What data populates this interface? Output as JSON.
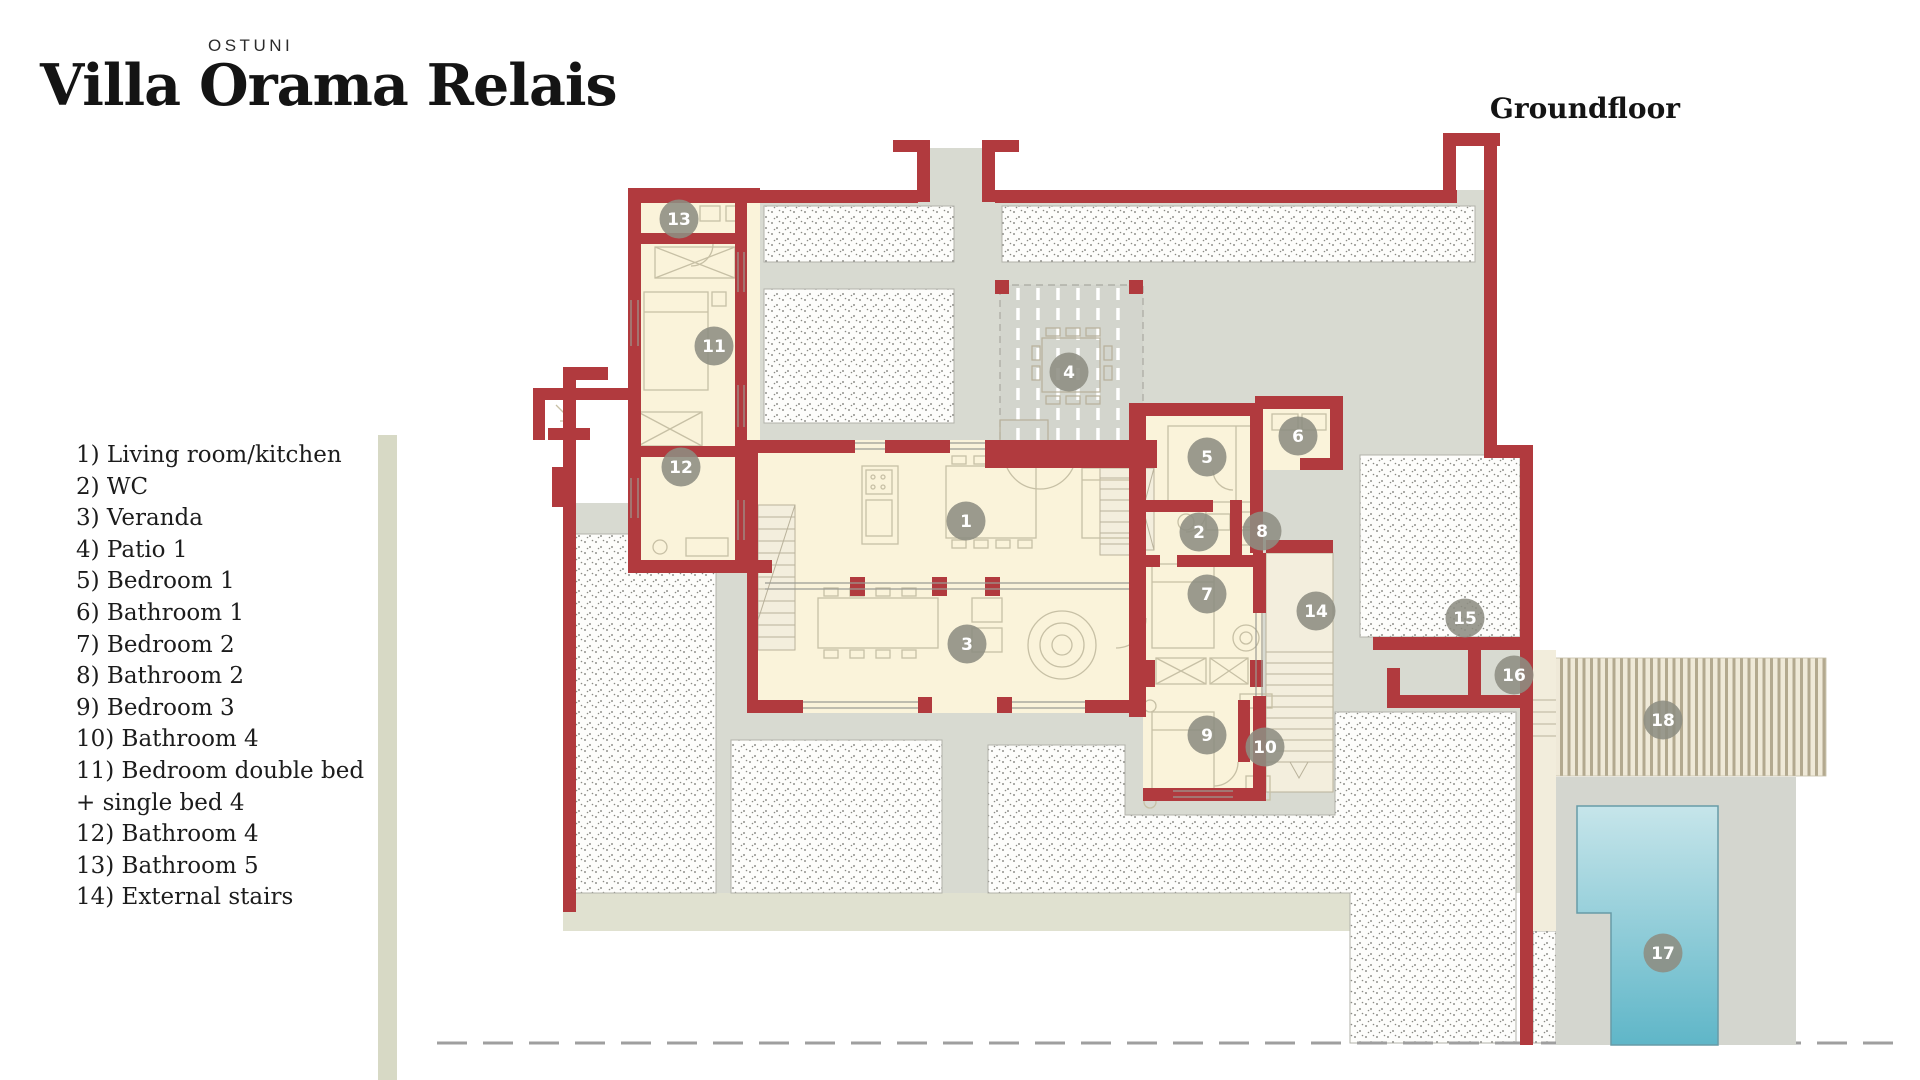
{
  "header": {
    "location": "OSTUNI",
    "title": "Villa Orama Relais",
    "floor_label": "Groundfloor"
  },
  "legend": {
    "items": [
      "1) Living room/kitchen",
      "2) WC",
      "3) Veranda",
      "4) Patio 1",
      "5) Bedroom 1",
      "6) Bathroom 1",
      "7) Bedroom 2",
      "8) Bathroom 2",
      "9) Bedroom 3",
      "10) Bathroom 4",
      "11) Bedroom double bed\n + single bed 4",
      "12) Bathroom 4",
      "13) Bathroom 5",
      "14) External stairs"
    ]
  },
  "plan": {
    "markers": [
      {
        "n": "1",
        "x": 966,
        "y": 521
      },
      {
        "n": "2",
        "x": 1199,
        "y": 532
      },
      {
        "n": "3",
        "x": 967,
        "y": 644
      },
      {
        "n": "4",
        "x": 1069,
        "y": 372
      },
      {
        "n": "5",
        "x": 1207,
        "y": 457
      },
      {
        "n": "6",
        "x": 1298,
        "y": 436
      },
      {
        "n": "7",
        "x": 1207,
        "y": 594
      },
      {
        "n": "8",
        "x": 1262,
        "y": 531
      },
      {
        "n": "9",
        "x": 1207,
        "y": 735
      },
      {
        "n": "10",
        "x": 1265,
        "y": 747
      },
      {
        "n": "11",
        "x": 714,
        "y": 346
      },
      {
        "n": "12",
        "x": 681,
        "y": 467
      },
      {
        "n": "13",
        "x": 679,
        "y": 219
      },
      {
        "n": "14",
        "x": 1316,
        "y": 611
      },
      {
        "n": "15",
        "x": 1465,
        "y": 618
      },
      {
        "n": "16",
        "x": 1514,
        "y": 675
      },
      {
        "n": "17",
        "x": 1663,
        "y": 953
      },
      {
        "n": "18",
        "x": 1663,
        "y": 720
      }
    ]
  },
  "colors": {
    "wall_red": "#b13a3e",
    "room_cream": "#faf3da",
    "deck_gray": "#d8dad1",
    "sage": "#d7d9c5",
    "pool_top": "#c6e5ea",
    "pool_bottom": "#5fb6c8",
    "marker_gray": "#8d8d82"
  }
}
